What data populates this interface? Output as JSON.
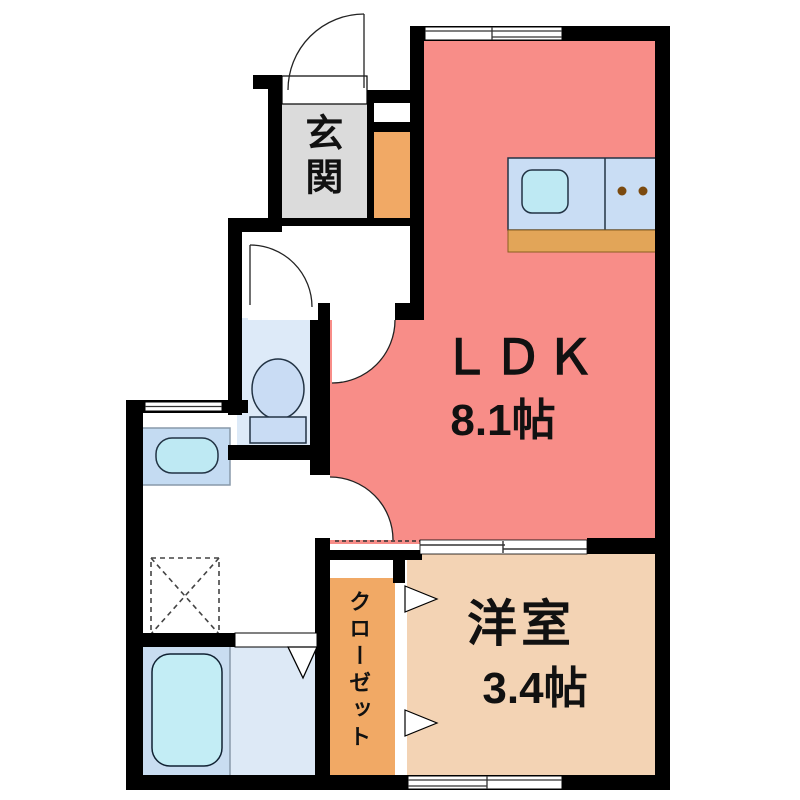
{
  "plan": {
    "ldk": {
      "label": "ＬＤＫ",
      "size": "8.1帖"
    },
    "western_room": {
      "label": "洋室",
      "size": "3.4帖"
    },
    "entrance": {
      "label": "玄関"
    },
    "closet": {
      "label": "クローゼット"
    }
  },
  "colors": {
    "wall": "#000000",
    "ldk": "#F88D88",
    "western_room": "#F3D3B4",
    "closet": "#F1A965",
    "entrance_floor": "#DBDBDB",
    "entrance_cabinet": "#F1A965",
    "toilet_room": "#DDEAF8",
    "toilet_fixture": "#C9DCF4",
    "kitchen_counter": "#C9DDF4",
    "kitchen_sink": "#BEE9F3",
    "kitchen_base": "#E2A558",
    "burner": "#7B4A0F",
    "vanity": "#C4DBF2",
    "basin": "#BEE9F3",
    "bath_tub_zone": "#C9DDF1",
    "bath_floor": "#DDE9F6",
    "bathtub": "#C3EDF5"
  }
}
